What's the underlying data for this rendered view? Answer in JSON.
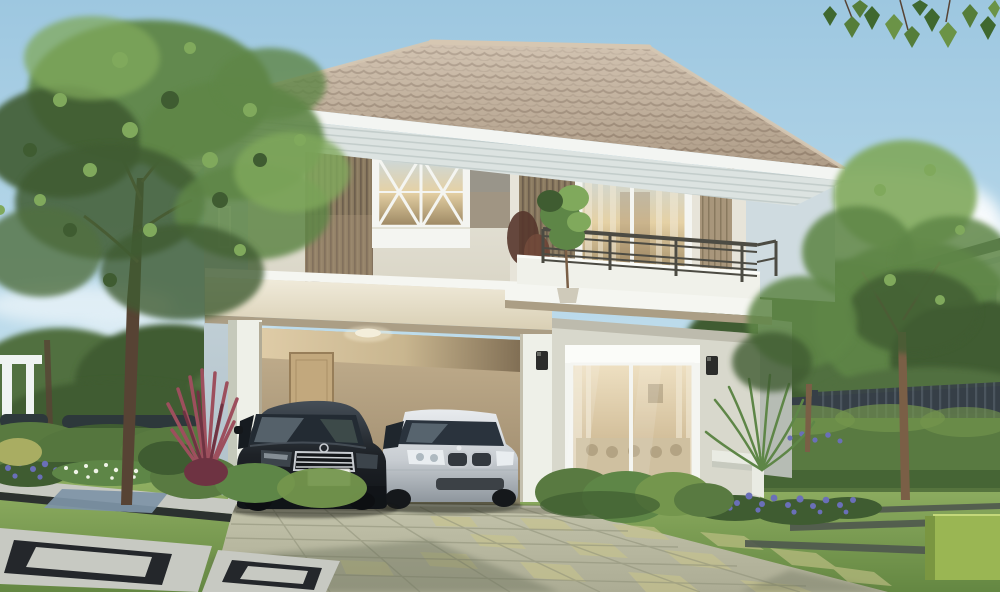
{
  "scene": {
    "type": "architectural-photo-rendering",
    "subject": "two-story suburban house with carport, two sedans, landscaped garden",
    "objects": [
      "sky",
      "clouds",
      "neighbor-house",
      "garden-fence",
      "hedges",
      "lawn",
      "main-house",
      "hip-tile-roof",
      "wood-slat-siding",
      "cross-muntin-window",
      "balcony",
      "balcony-railing",
      "balcony-plant",
      "carport",
      "carport-ceiling-light",
      "carport-door",
      "black-sedan",
      "silver-sedan",
      "license-plate",
      "sliding-glass-door",
      "wall-sconces",
      "garden-bench",
      "driveway",
      "paver-walkway",
      "flower-beds",
      "cordyline-plant",
      "large-tree",
      "slim-tree",
      "hanging-leaves"
    ],
    "license_plate_text": ""
  },
  "colors": {
    "sky_top": "#9dc7e0",
    "sky_mid": "#bcdbeb",
    "sky_low": "#e0eef3",
    "cloud": "#ffffff",
    "far_tree": "#51703f",
    "mid_tree": "#5e8647",
    "light_tree": "#80a95c",
    "dark_tree": "#3f5c31",
    "trunk": "#7a5f46",
    "trunk_dark": "#574334",
    "fence": "#363f47",
    "fence_light": "#4d5761",
    "neighbor_wall": "#e2ebef",
    "neighbor_shadow": "#bfcfd6",
    "neighbor_roof": "#434a4e",
    "neighbor_window": "#7d8d96",
    "pergola_white": "#eff3f2",
    "wall_cap": "#2d383b",
    "hedge": "#597a41",
    "hedge_light": "#74964d",
    "hedge_dark": "#3f5c31",
    "hedge_cube": "#9ab653",
    "lawn": "#84a556",
    "lawn_light": "#9cba6b",
    "lawn_dark": "#648742",
    "yellow_bush": "#a9ad62",
    "roof_tile": "#c6b39c",
    "roof_tile_line": "#94806c",
    "roof_tile_dark": "#ab9883",
    "ridge": "#d6c7b2",
    "fascia": "#f3f5f2",
    "soffit": "#dce3e1",
    "soffit_line": "#bdc8c6",
    "wall_cream": "#ebe9e0",
    "wall_cream_dark": "#d8d4c4",
    "side_blue": "#b0c1ca",
    "side_blue_light": "#cfdbe0",
    "side_gray": "#b6bcb4",
    "wood_dark": "#6d5f4e",
    "wood_mid": "#89795f",
    "wood_light": "#a8967b",
    "panel_gray": "#99958a",
    "pilaster": "#e7e4d9",
    "frame_white": "#f4f5f1",
    "glass_cool": "#ccd8da",
    "glass_warm": "#e5d1a5",
    "glass_deep": "#9c8762",
    "curtain": "#f2ead6",
    "railing": "#4c4b43",
    "parapet": "#f0f1ea",
    "slab": "#f5f6f1",
    "beam": "#e7e0cc",
    "beam_shadow": "#ab9e85",
    "carport_wall": "#c4b190",
    "carport_wall_dark": "#9a876a",
    "carport_ceiling": "#e0cda8",
    "door_tan": "#c2a87d",
    "door_edge": "#977e59",
    "column": "#eef0e8",
    "column_side": "#c5c9bb",
    "column_shade": "#b2ab96",
    "gf_wall": "#d8d8cc",
    "gf_wall_dark": "#bcc0b4",
    "sconce": "#2c2d2b",
    "bench": "#e9ebe3",
    "bench_side": "#c7cabf",
    "sofa": "#cfc0a0",
    "sofa_dark": "#b3a383",
    "car_black": "#1e2227",
    "car_black_hi": "#454e57",
    "car_glass": "#2a333d",
    "car_chrome": "#c8ccd1",
    "car_silver": "#c7ccd1",
    "car_silver_dark": "#8e969d",
    "car_silver_hi": "#e8ebee",
    "car_grille": "#33383e",
    "plate": "#f2f3ee",
    "drive": "#b8b8a0",
    "drive_tile": "#c8c48c",
    "drive_line": "#8f9179",
    "drive_edge": "#e0e0cf",
    "drive_shadow": "#5c6350",
    "paver": "#c7c9c2",
    "paver_dark": "#24272b",
    "paver_blue": "#7e94a7",
    "flower_purple": "#6a6fb8",
    "flower_white": "#f0f4e8",
    "cordyline": "#9d4f5d",
    "cordyline_dark": "#6e3342",
    "shadow": "#2e3a2a"
  }
}
